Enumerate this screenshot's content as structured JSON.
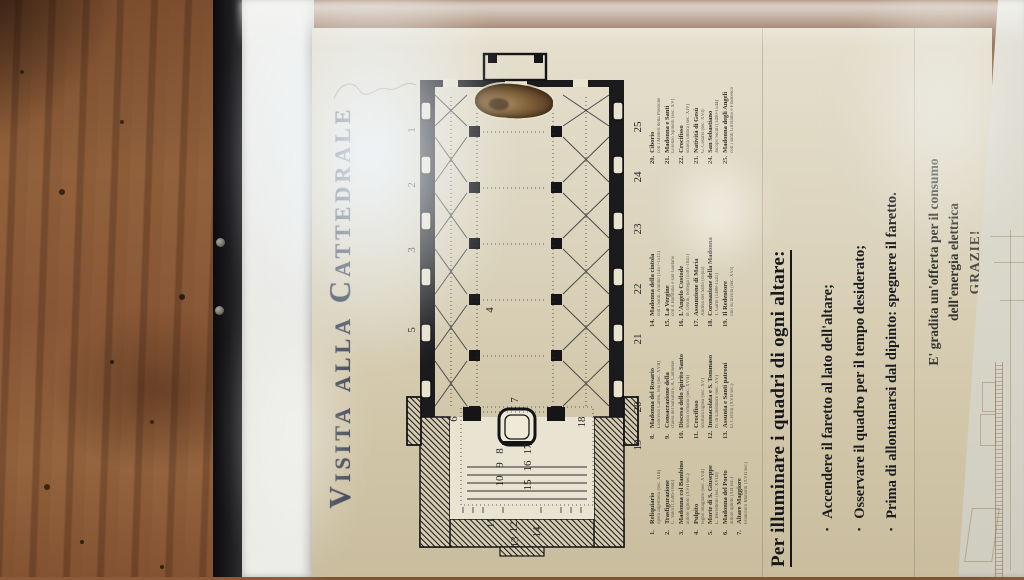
{
  "poster": {
    "title": "Visita alla Cattedrale",
    "plan": {
      "labels": [
        {
          "t": "1",
          "x": 427,
          "y": 10
        },
        {
          "t": "2",
          "x": 372,
          "y": 10
        },
        {
          "t": "3",
          "x": 307,
          "y": 10
        },
        {
          "t": "5",
          "x": 227,
          "y": 10
        },
        {
          "t": "4",
          "x": 247,
          "y": 88
        },
        {
          "t": "6",
          "x": 138,
          "y": 52
        },
        {
          "t": "7",
          "x": 157,
          "y": 113
        },
        {
          "t": "8",
          "x": 106,
          "y": 98
        },
        {
          "t": "9",
          "x": 92,
          "y": 98
        },
        {
          "t": "10",
          "x": 76,
          "y": 98
        },
        {
          "t": "15",
          "x": 72,
          "y": 126
        },
        {
          "t": "16",
          "x": 91,
          "y": 126
        },
        {
          "t": "17",
          "x": 108,
          "y": 126
        },
        {
          "t": "11",
          "x": 34,
          "y": 89
        },
        {
          "t": "12",
          "x": 30,
          "y": 112
        },
        {
          "t": "13",
          "x": 15,
          "y": 113
        },
        {
          "t": "14",
          "x": 25,
          "y": 135
        },
        {
          "t": "18",
          "x": 135,
          "y": 180
        },
        {
          "t": "19",
          "x": 112,
          "y": 236
        },
        {
          "t": "20",
          "x": 150,
          "y": 236
        },
        {
          "t": "21",
          "x": 218,
          "y": 236
        },
        {
          "t": "22",
          "x": 268,
          "y": 236
        },
        {
          "t": "23",
          "x": 328,
          "y": 236
        },
        {
          "t": "24",
          "x": 380,
          "y": 236
        },
        {
          "t": "25",
          "x": 430,
          "y": 236
        }
      ]
    },
    "legend": {
      "columns": [
        {
          "items": [
            {
              "n": "1.",
              "label": "Reliquiario",
              "sub": "opera argentiera (sec. XIII)"
            },
            {
              "n": "2.",
              "label": "Trasfigurazione",
              "sub": "C. Valori (1586-1660)"
            },
            {
              "n": "3.",
              "label": "Madonna col Bambino",
              "sub": "autore ignoto (XVII sec.)"
            },
            {
              "n": "4.",
              "label": "Pulpito",
              "sub": "legno intagliato (sec. XVII)"
            },
            {
              "n": "5.",
              "label": "Morte di S. Giuseppe",
              "sub": "L. Berrettoni (sec. XVIII)"
            },
            {
              "n": "6.",
              "label": "Madonna del Porto",
              "sub": "autore ignoto (XII sec.)"
            },
            {
              "n": "7.",
              "label": "Altare Maggiore",
              "sub": "Francesco Manardi (XVII sec.)"
            }
          ]
        },
        {
          "items": [
            {
              "n": "8.",
              "label": "Madonna del Rosario",
              "sub": "Lodovico Carosi, tela (sec. XVII)"
            },
            {
              "n": "9.",
              "label": "Consacrazione della",
              "sub": "chiesa del Salvatore, A. Camassei"
            },
            {
              "n": "10.",
              "label": "Discesa dello Spirito Santo",
              "sub": "scuola romana (sec. XVII)"
            },
            {
              "n": "11.",
              "label": "Crocifisso",
              "sub": "scultura lignea (sec. XV)"
            },
            {
              "n": "12.",
              "label": "Immacolata e S. Tommaso",
              "sub": "N. di Liberatore (sec. XV)"
            },
            {
              "n": "13.",
              "label": "Assunta e Santi patroni",
              "sub": "D. Cerrini (XVII sec.)"
            }
          ]
        },
        {
          "items": [
            {
              "n": "14.",
              "label": "Madonna della cintola",
              "sub": "con i Santi. Alunno (1457-1511)"
            },
            {
              "n": "15.",
              "label": "La Vergine",
              "sub": "con il Bambino e san Gaetano"
            },
            {
              "n": "16.",
              "label": "L'Angelo Custode",
              "sub": "B. Orsini, bottega (1581-1641)"
            },
            {
              "n": "17.",
              "label": "Assunzione di Maria",
              "sub": "Andrea del Sarto (copia)"
            },
            {
              "n": "18.",
              "label": "Coronazione della Madonna",
              "sub": "T. Garbi (1488-1541)"
            },
            {
              "n": "19.",
              "label": "Il Redentore",
              "sub": "olio su tavola (sec. XVI)"
            }
          ]
        },
        {
          "items": [
            {
              "n": "20.",
              "label": "Ciborio",
              "sub": "con i Misteri della Passione"
            },
            {
              "n": "21.",
              "label": "Madonna e Santi",
              "sub": "Lorenzo Spinelli (sec. XV)"
            },
            {
              "n": "22.",
              "label": "Crocifisso",
              "sub": "scuola umbra (sec. XIV)"
            },
            {
              "n": "23.",
              "label": "Natività di Gesù",
              "sub": "G. Cesarei (sec. XVI)"
            },
            {
              "n": "24.",
              "label": "San Sebastiano",
              "sub": "Jacopo Siculi (1490-1544)"
            },
            {
              "n": "25.",
              "label": "Madonna degli Angeli",
              "sub": "con i santi Girolamo e Francesco"
            }
          ]
        }
      ]
    },
    "instructions": {
      "heading": "Per illuminare i quadri di ogni altare:",
      "bullets": [
        "Accendere il faretto al lato dell'altare;",
        "Osservare il quadro per il tempo desiderato;",
        "Prima di allontanarsi dal dipinto: spegnere il faretto."
      ]
    },
    "offering": {
      "line1": "E' gradita un'offerta per il consumo",
      "line2": "dell'energia elettrica",
      "line3": "GRAZIE!"
    }
  }
}
